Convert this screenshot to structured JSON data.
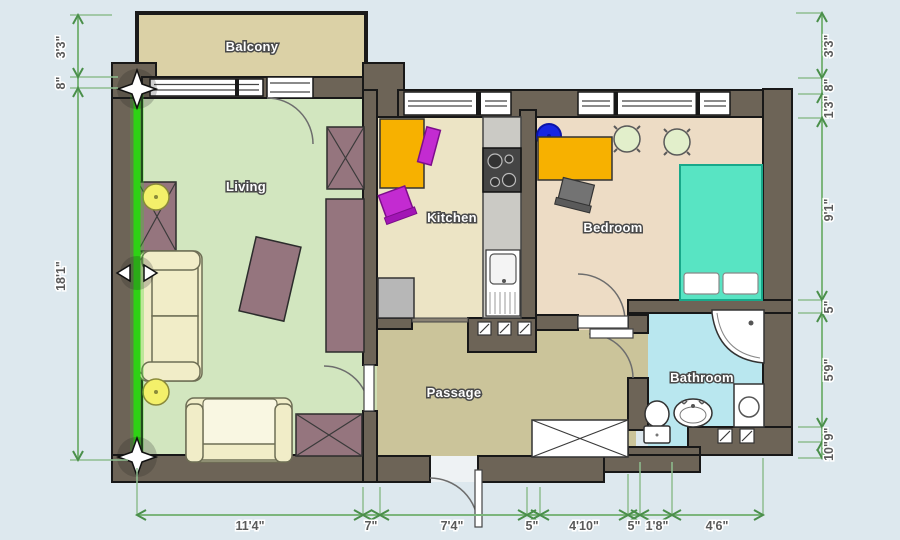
{
  "scene": {
    "type": "floor-plan-editor",
    "background": "#dde8ee"
  },
  "rooms": {
    "balcony": {
      "label": "Balcony"
    },
    "living": {
      "label": "Living"
    },
    "kitchen": {
      "label": "Kitchen"
    },
    "bedroom": {
      "label": "Bedroom"
    },
    "bathroom": {
      "label": "Bathroom"
    },
    "passage": {
      "label": "Passage"
    }
  },
  "dimensions": {
    "left": [
      {
        "label": "3'3\""
      },
      {
        "label": "8\""
      },
      {
        "label": "18'1\""
      }
    ],
    "right": [
      {
        "label": "3'3\""
      },
      {
        "label": "8\""
      },
      {
        "label": "1'3\""
      },
      {
        "label": "9'1\""
      },
      {
        "label": "5\""
      },
      {
        "label": "5'9\""
      },
      {
        "label": "9\""
      },
      {
        "label": "10\""
      }
    ],
    "bottom": [
      {
        "label": "11'4\""
      },
      {
        "label": "7\""
      },
      {
        "label": "7'4\""
      },
      {
        "label": "5\""
      },
      {
        "label": "4'10\""
      },
      {
        "label": "5\""
      },
      {
        "label": "1'8\""
      },
      {
        "label": "4'6\""
      }
    ]
  },
  "selection": {
    "selected_element": "living-left-wall",
    "highlight_color": "#2ed315",
    "handles": [
      "move-star-handle-top",
      "stretch-arrows-handle-middle",
      "move-star-handle-bottom"
    ]
  },
  "colors": {
    "wall": "#6d6457",
    "living": "#d2e6bf",
    "balcony": "#dbd1a6",
    "kitchen": "#ece4c5",
    "bedroom": "#eddcc5",
    "passage": "#cbc49a",
    "bathroom": "#b9e7ef",
    "bed": "#58e4c3",
    "table": "#f7b100",
    "chair_accent": "#c32bd1",
    "stool": "#1726e3",
    "furniture_wood": "#95757e",
    "sofa": "#f1edc8",
    "lamp": "#f3f06a",
    "dimension": "#7cb57c"
  },
  "furniture": {
    "living": [
      "wardrobe",
      "floor-lamp",
      "sofa",
      "floor-lamp",
      "armchair",
      "coffee-table",
      "wardrobe",
      "sideboard",
      "side-table"
    ],
    "kitchen": [
      "dining-table",
      "chair",
      "chair",
      "counter",
      "stove",
      "kitchen-sink",
      "cabinet"
    ],
    "bedroom": [
      "stool",
      "desk",
      "desk-chair",
      "round-table",
      "round-table",
      "double-bed"
    ],
    "bathroom": [
      "corner-shower",
      "washing-machine",
      "wash-basin",
      "toilet"
    ],
    "passage": [
      "built-in-closet"
    ]
  }
}
